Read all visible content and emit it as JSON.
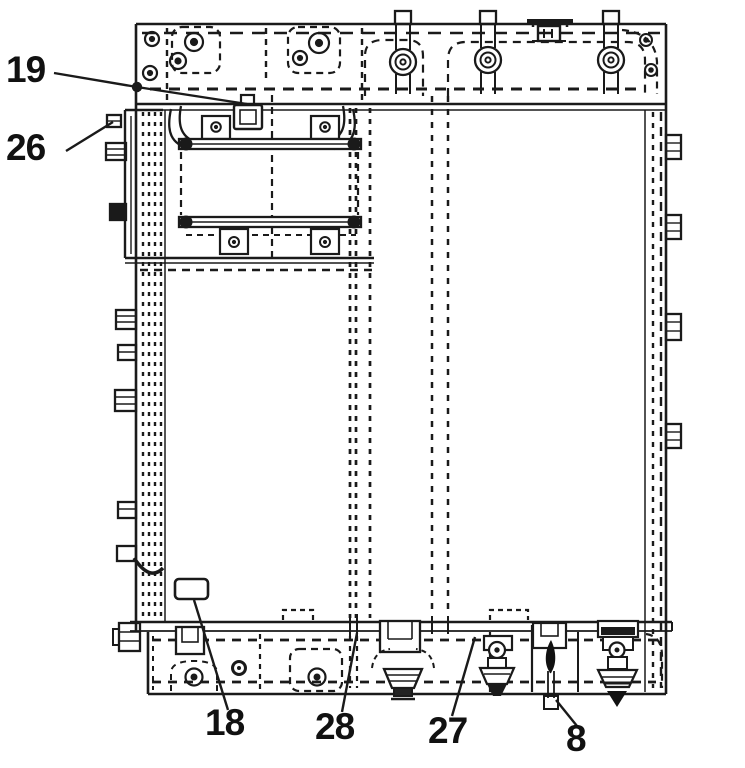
{
  "figure": {
    "background": "#ffffff",
    "ink": "#1a1a1a",
    "callouts": [
      {
        "label": "19"
      },
      {
        "label": "26"
      },
      {
        "label": "18"
      },
      {
        "label": "28"
      },
      {
        "label": "27"
      },
      {
        "label": "8"
      }
    ]
  }
}
